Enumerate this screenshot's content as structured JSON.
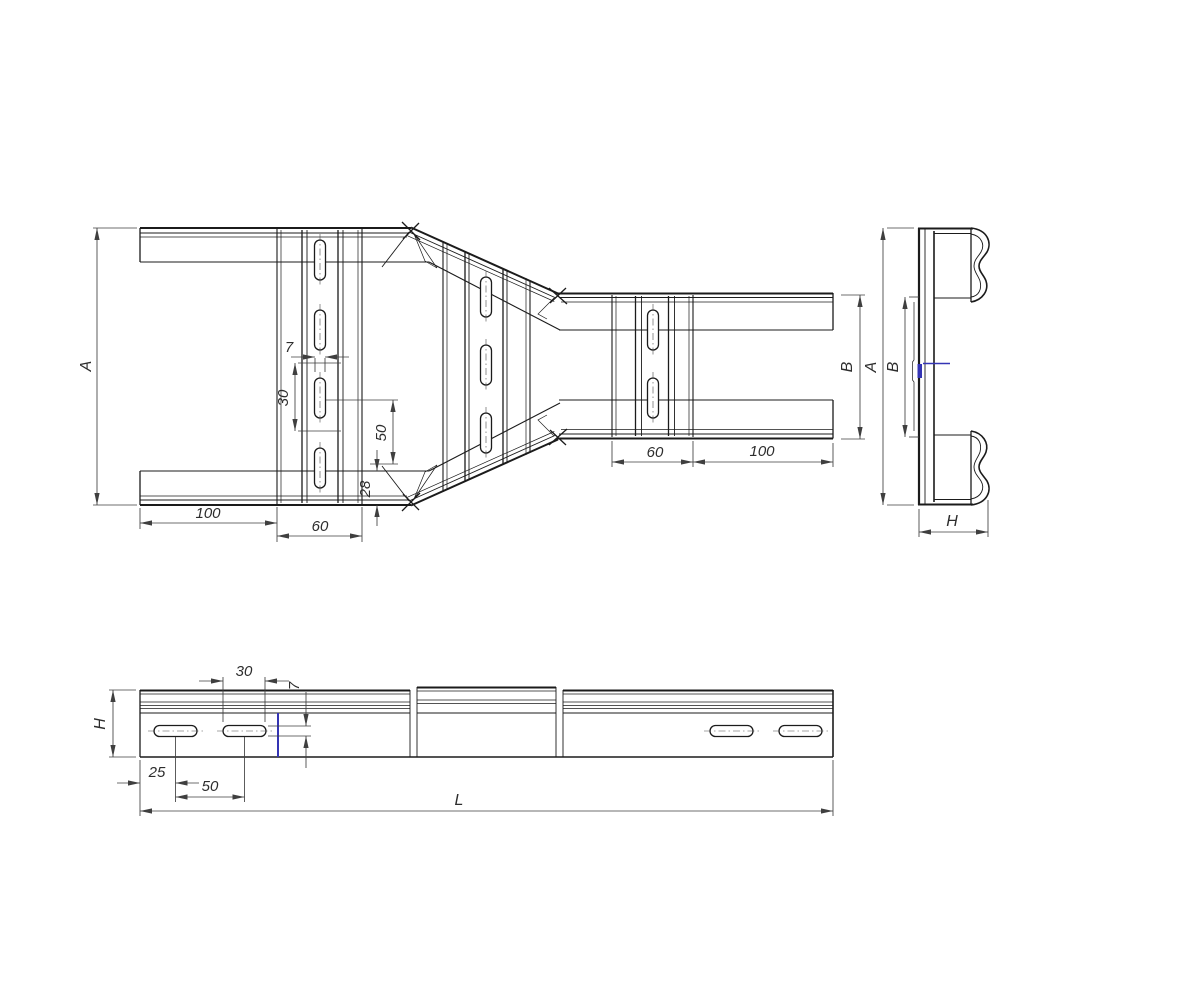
{
  "drawing": {
    "background": "#ffffff",
    "line_color": "#1b1b1b",
    "dim_color": "#3f3f3f",
    "accent_color": "#3434b4",
    "views": {
      "plan": {
        "description": "top view of ladder reducer",
        "dims": {
          "overall_height": "A",
          "left_rail_to_rung": "100",
          "wide_rung_width": "60",
          "slot_width": "7",
          "slot_span": "30",
          "slot_pitch": "50",
          "rail_depth": "28",
          "narrow_rung_width": "60",
          "narrow_rung_to_end": "100",
          "narrow_height": "B"
        }
      },
      "end": {
        "description": "end profile view",
        "dims": {
          "overall_height": "A",
          "inner_height": "B",
          "profile_depth": "H"
        }
      },
      "side": {
        "description": "side elevation of rail",
        "dims": {
          "profile_height": "H",
          "slot_length": "30",
          "slot_height": "7",
          "end_to_first_slot": "25",
          "slot_pitch": "50",
          "overall_length": "L"
        }
      }
    }
  }
}
